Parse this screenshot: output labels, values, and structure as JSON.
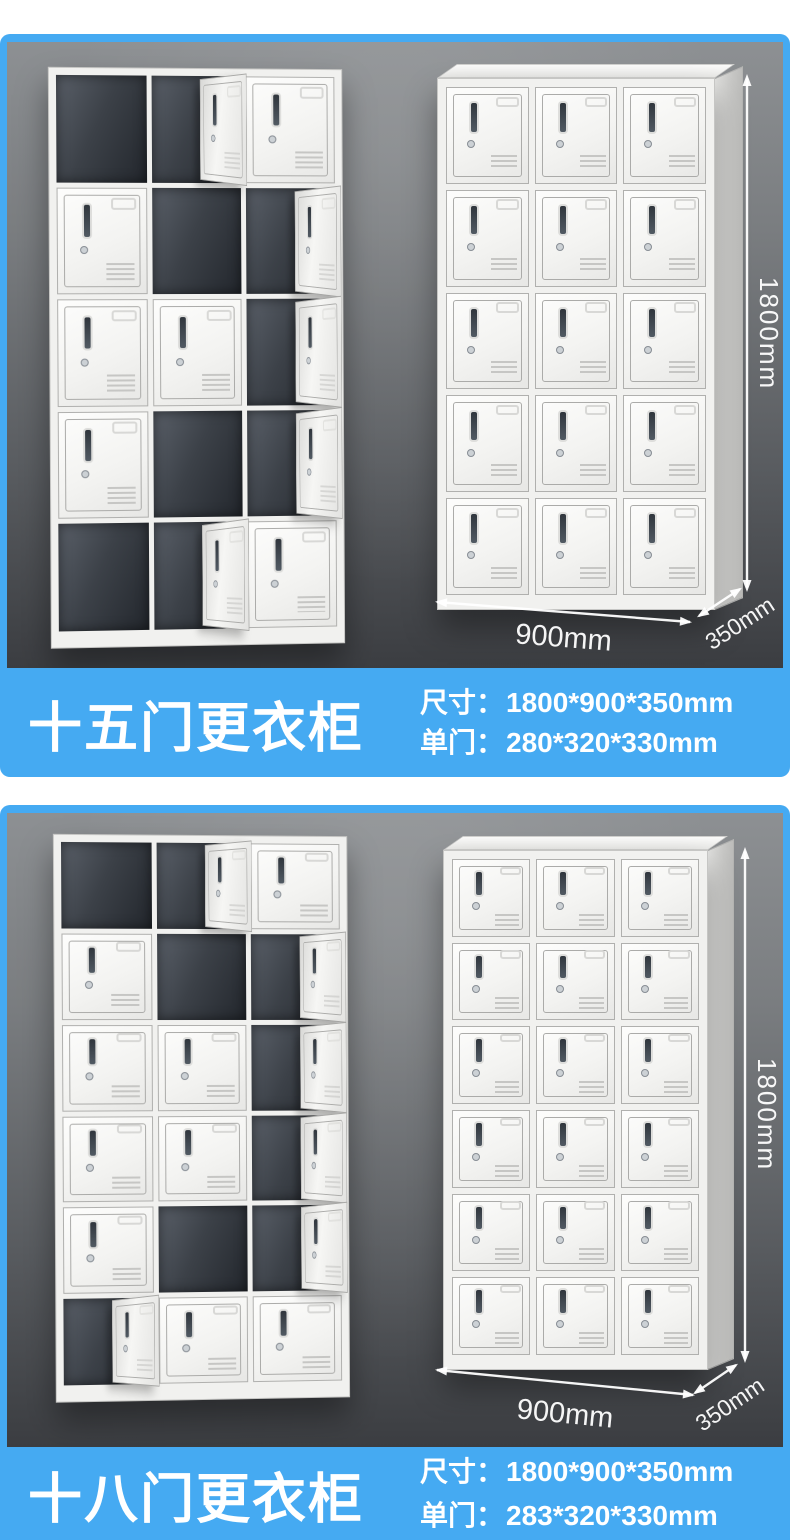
{
  "theme": {
    "accent_blue": "#45aaf2",
    "panel_gray_top": "#8d9093",
    "panel_gray_bottom": "#3b3d41",
    "text_color": "#ffffff"
  },
  "sections": [
    {
      "title": "十五门更衣柜",
      "specs": [
        {
          "label": "尺寸：",
          "value": "1800*900*350mm"
        },
        {
          "label": "单门：",
          "value": "280*320*330mm"
        }
      ],
      "dimensions": {
        "height": "1800mm",
        "width": "900mm",
        "depth": "350mm"
      },
      "left_locker": {
        "rows": 5,
        "cols": 3,
        "cells": [
          [
            "dark",
            "ajar",
            "closed"
          ],
          [
            "closed",
            "dark",
            "ajar"
          ],
          [
            "closed",
            "closed",
            "ajar"
          ],
          [
            "closed",
            "dark",
            "ajar"
          ],
          [
            "dark",
            "ajar",
            "closed"
          ]
        ]
      },
      "right_locker": {
        "rows": 5,
        "cols": 3
      }
    },
    {
      "title": "十八门更衣柜",
      "specs": [
        {
          "label": "尺寸：",
          "value": "1800*900*350mm"
        },
        {
          "label": "单门：",
          "value": "283*320*330mm"
        }
      ],
      "dimensions": {
        "height": "1800mm",
        "width": "900mm",
        "depth": "350mm"
      },
      "left_locker": {
        "rows": 6,
        "cols": 3,
        "cells": [
          [
            "dark",
            "ajar",
            "closed"
          ],
          [
            "closed",
            "dark",
            "ajar"
          ],
          [
            "closed",
            "closed",
            "ajar"
          ],
          [
            "closed",
            "closed",
            "ajar"
          ],
          [
            "closed",
            "dark",
            "ajar"
          ],
          [
            "ajar",
            "closed",
            "closed"
          ]
        ]
      },
      "right_locker": {
        "rows": 6,
        "cols": 3
      }
    }
  ]
}
